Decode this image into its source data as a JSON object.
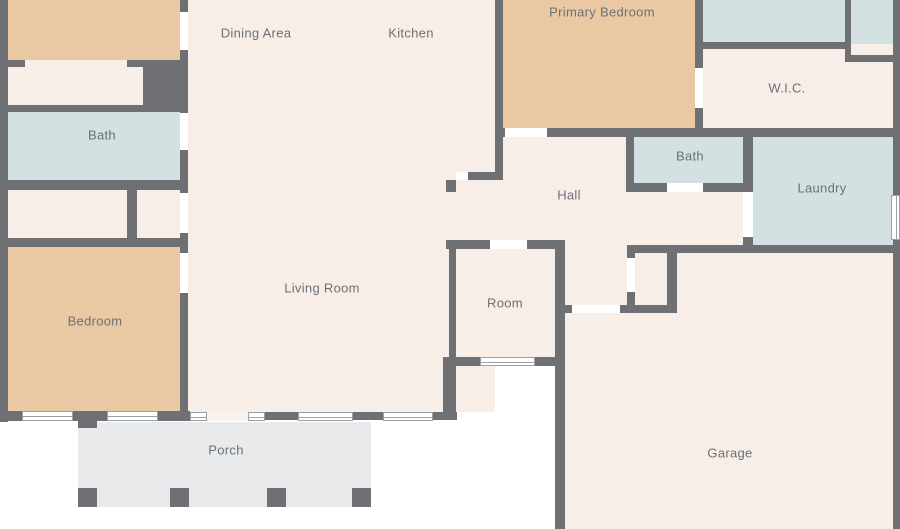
{
  "title": "floor-plan",
  "colors": {
    "wall": "#6e7073",
    "cream": "#f7eee8",
    "tan": "#ebc8a4",
    "blue": "#d3e1e3",
    "porch": "#e9eaec",
    "window": "#ffffff",
    "label_text": "#6b7178",
    "background": "#ffffff"
  },
  "labels": [
    {
      "name": "label-dining-area",
      "text": "Dining Area",
      "x": 256,
      "y": 33
    },
    {
      "name": "label-kitchen",
      "text": "Kitchen",
      "x": 411,
      "y": 33
    },
    {
      "name": "label-primary-bedroom",
      "text": "Primary Bedroom",
      "x": 602,
      "y": 12
    },
    {
      "name": "label-wic",
      "text": "W.I.C.",
      "x": 787,
      "y": 88
    },
    {
      "name": "label-bath-hall",
      "text": "Bath",
      "x": 690,
      "y": 156
    },
    {
      "name": "label-laundry",
      "text": "Laundry",
      "x": 822,
      "y": 188
    },
    {
      "name": "label-hall",
      "text": "Hall",
      "x": 569,
      "y": 195
    },
    {
      "name": "label-bath-left",
      "text": "Bath",
      "x": 102,
      "y": 135
    },
    {
      "name": "label-bedroom",
      "text": "Bedroom",
      "x": 95,
      "y": 321
    },
    {
      "name": "label-living-room",
      "text": "Living Room",
      "x": 322,
      "y": 288
    },
    {
      "name": "label-room",
      "text": "Room",
      "x": 505,
      "y": 303
    },
    {
      "name": "label-garage",
      "text": "Garage",
      "x": 730,
      "y": 453
    },
    {
      "name": "label-porch",
      "text": "Porch",
      "x": 226,
      "y": 450
    }
  ],
  "rooms": [
    {
      "name": "room-bedroom-top-fill",
      "color": "tan",
      "rect": [
        8,
        0,
        172,
        60
      ]
    },
    {
      "name": "room-closet-top-fill",
      "color": "cream",
      "rect": [
        8,
        60,
        135,
        45
      ]
    },
    {
      "name": "room-bath-left-fill",
      "color": "blue",
      "rect": [
        8,
        112,
        172,
        68
      ]
    },
    {
      "name": "room-closet-row-fill",
      "color": "cream",
      "rect": [
        8,
        188,
        172,
        52
      ]
    },
    {
      "name": "room-bedroom-fill",
      "color": "tan",
      "rect": [
        8,
        247,
        172,
        165
      ]
    },
    {
      "name": "room-main-open-fill",
      "color": "cream",
      "rect": [
        188,
        0,
        307,
        412
      ]
    },
    {
      "name": "room-primary-bedroom-fill",
      "color": "tan",
      "rect": [
        503,
        0,
        192,
        130
      ]
    },
    {
      "name": "room-blue-top-1-fill",
      "color": "blue",
      "rect": [
        703,
        0,
        142,
        44
      ]
    },
    {
      "name": "room-blue-top-2-fill",
      "color": "blue",
      "rect": [
        851,
        0,
        42,
        57
      ]
    },
    {
      "name": "room-wic-fill",
      "color": "cream",
      "rect": [
        697,
        44,
        196,
        84
      ]
    },
    {
      "name": "room-hall-fill",
      "color": "cream",
      "rect": [
        443,
        130,
        300,
        118
      ]
    },
    {
      "name": "room-bath-hall-fill",
      "color": "blue",
      "rect": [
        634,
        137,
        109,
        47
      ]
    },
    {
      "name": "room-laundry-fill",
      "color": "blue",
      "rect": [
        750,
        137,
        143,
        108
      ]
    },
    {
      "name": "room-room-fill",
      "color": "cream",
      "rect": [
        456,
        245,
        99,
        112
      ]
    },
    {
      "name": "room-garage-fill",
      "color": "cream",
      "rect": [
        560,
        245,
        333,
        284
      ]
    },
    {
      "name": "room-closet-garage-fill",
      "color": "cream",
      "rect": [
        635,
        253,
        32,
        50
      ]
    },
    {
      "name": "room-porch-fill",
      "color": "porch",
      "rect": [
        78,
        422,
        293,
        85
      ]
    }
  ],
  "walls": [
    {
      "name": "wall-left-exterior",
      "rect": [
        0,
        0,
        8,
        422
      ]
    },
    {
      "name": "wall-dining-left-top",
      "rect": [
        180,
        0,
        8,
        12
      ]
    },
    {
      "name": "wall-dining-left-mid",
      "rect": [
        180,
        50,
        8,
        63
      ]
    },
    {
      "name": "wall-thick-block",
      "rect": [
        143,
        60,
        39,
        52
      ]
    },
    {
      "name": "wall-closet-top-a",
      "rect": [
        0,
        60,
        25,
        7
      ]
    },
    {
      "name": "wall-closet-top-b",
      "rect": [
        127,
        60,
        16,
        7
      ]
    },
    {
      "name": "wall-bath-left-top",
      "rect": [
        0,
        105,
        182,
        7
      ]
    },
    {
      "name": "wall-bath-left-right",
      "rect": [
        180,
        150,
        8,
        43
      ]
    },
    {
      "name": "wall-bath-left-bottom",
      "rect": [
        0,
        180,
        183,
        10
      ]
    },
    {
      "name": "wall-closet-divider",
      "rect": [
        127,
        188,
        10,
        52
      ]
    },
    {
      "name": "wall-living-left-a",
      "rect": [
        180,
        233,
        8,
        20
      ]
    },
    {
      "name": "wall-bedroom-top",
      "rect": [
        0,
        238,
        188,
        9
      ]
    },
    {
      "name": "wall-bedroom-right",
      "rect": [
        180,
        293,
        8,
        119
      ]
    },
    {
      "name": "wall-bedroom-bottom-a",
      "rect": [
        0,
        411,
        22,
        10
      ]
    },
    {
      "name": "wall-bedroom-bottom-b",
      "rect": [
        73,
        411,
        34,
        10
      ]
    },
    {
      "name": "wall-bedroom-bottom-c",
      "rect": [
        158,
        411,
        32,
        10
      ]
    },
    {
      "name": "wall-living-bottom-a",
      "rect": [
        265,
        412,
        33,
        8
      ]
    },
    {
      "name": "wall-living-bottom-b",
      "rect": [
        353,
        412,
        30,
        8
      ]
    },
    {
      "name": "wall-living-bottom-c",
      "rect": [
        433,
        412,
        24,
        8
      ]
    },
    {
      "name": "wall-living-right-lower",
      "rect": [
        443,
        357,
        13,
        63
      ]
    },
    {
      "name": "wall-room-left",
      "rect": [
        449,
        240,
        7,
        126
      ]
    },
    {
      "name": "wall-room-top-a",
      "rect": [
        446,
        240,
        44,
        9
      ]
    },
    {
      "name": "wall-room-top-b",
      "rect": [
        527,
        240,
        38,
        9
      ]
    },
    {
      "name": "wall-room-bottom",
      "rect": [
        449,
        357,
        116,
        9
      ]
    },
    {
      "name": "wall-room-garage-right",
      "rect": [
        555,
        240,
        10,
        289
      ]
    },
    {
      "name": "wall-garage-door-stub",
      "rect": [
        562,
        305,
        10,
        8
      ]
    },
    {
      "name": "wall-garage-top-left",
      "rect": [
        620,
        305,
        57,
        8
      ]
    },
    {
      "name": "wall-closet-garage-left-a",
      "rect": [
        627,
        250,
        8,
        8
      ]
    },
    {
      "name": "wall-closet-garage-left-b",
      "rect": [
        627,
        292,
        8,
        13
      ]
    },
    {
      "name": "wall-closet-garage-right",
      "rect": [
        667,
        250,
        10,
        58
      ]
    },
    {
      "name": "wall-laundry-garage-bottom",
      "rect": [
        627,
        245,
        273,
        8
      ]
    },
    {
      "name": "wall-kitchen-right",
      "rect": [
        495,
        0,
        8,
        180
      ]
    },
    {
      "name": "wall-primary-bottom-stub",
      "rect": [
        495,
        128,
        10,
        9
      ]
    },
    {
      "name": "wall-primary-bottom",
      "rect": [
        547,
        128,
        353,
        9
      ]
    },
    {
      "name": "wall-hall-nook",
      "rect": [
        468,
        172,
        35,
        8
      ]
    },
    {
      "name": "wall-hall-nook-stub",
      "rect": [
        446,
        180,
        10,
        12
      ]
    },
    {
      "name": "wall-bath-hall-left",
      "rect": [
        626,
        128,
        8,
        62
      ]
    },
    {
      "name": "wall-bath-hall-bottom-a",
      "rect": [
        626,
        183,
        41,
        9
      ]
    },
    {
      "name": "wall-bath-hall-bottom-b",
      "rect": [
        703,
        183,
        47,
        9
      ]
    },
    {
      "name": "wall-laundry-left-a",
      "rect": [
        743,
        128,
        10,
        64
      ]
    },
    {
      "name": "wall-laundry-left-b",
      "rect": [
        743,
        237,
        10,
        16
      ]
    },
    {
      "name": "wall-primary-right-a",
      "rect": [
        695,
        0,
        8,
        68
      ]
    },
    {
      "name": "wall-primary-right-b",
      "rect": [
        695,
        108,
        8,
        29
      ]
    },
    {
      "name": "wall-blue1-bottom",
      "rect": [
        697,
        42,
        154,
        7
      ]
    },
    {
      "name": "wall-blue2-left",
      "rect": [
        845,
        0,
        6,
        62
      ]
    },
    {
      "name": "wall-blue2-bottom",
      "rect": [
        845,
        55,
        55,
        7
      ]
    },
    {
      "name": "wall-right-exterior",
      "rect": [
        893,
        0,
        7,
        529
      ]
    }
  ],
  "doors": [
    {
      "name": "door-bedroomtop-dining",
      "rect": [
        180,
        12,
        8,
        38
      ],
      "style": "white"
    },
    {
      "name": "door-bath-left",
      "rect": [
        180,
        113,
        8,
        37
      ],
      "style": "white"
    },
    {
      "name": "door-closet-row",
      "rect": [
        180,
        193,
        8,
        40
      ],
      "style": "white"
    },
    {
      "name": "door-bedroom",
      "rect": [
        180,
        253,
        8,
        40
      ],
      "style": "white"
    },
    {
      "name": "door-primary-bedroom",
      "rect": [
        505,
        128,
        42,
        9
      ],
      "style": "white"
    },
    {
      "name": "door-room",
      "rect": [
        490,
        240,
        37,
        9
      ],
      "style": "white"
    },
    {
      "name": "door-garage",
      "rect": [
        572,
        305,
        48,
        8
      ],
      "style": "white"
    },
    {
      "name": "door-closet-garage",
      "rect": [
        627,
        258,
        8,
        34
      ],
      "style": "white"
    },
    {
      "name": "door-bath-hall",
      "rect": [
        667,
        183,
        36,
        9
      ],
      "style": "white"
    },
    {
      "name": "door-laundry",
      "rect": [
        743,
        192,
        10,
        45
      ],
      "style": "white"
    },
    {
      "name": "door-wic",
      "rect": [
        695,
        68,
        8,
        40
      ],
      "style": "white"
    },
    {
      "name": "door-hall-nook",
      "rect": [
        456,
        172,
        12,
        8
      ],
      "style": "white"
    },
    {
      "name": "door-front-entry",
      "rect": [
        207,
        412,
        41,
        9
      ],
      "style": "cream"
    }
  ],
  "windows": [
    {
      "name": "window-bedroom-1",
      "rect": [
        22,
        411,
        51,
        10
      ],
      "dir": "h"
    },
    {
      "name": "window-bedroom-2",
      "rect": [
        107,
        411,
        51,
        10
      ],
      "dir": "h"
    },
    {
      "name": "window-entry-sidelight-1",
      "rect": [
        190,
        412,
        17,
        9
      ],
      "dir": "h"
    },
    {
      "name": "window-entry-sidelight-2",
      "rect": [
        248,
        412,
        17,
        9
      ],
      "dir": "h"
    },
    {
      "name": "window-living-1",
      "rect": [
        298,
        412,
        55,
        9
      ],
      "dir": "h"
    },
    {
      "name": "window-living-2",
      "rect": [
        383,
        412,
        50,
        9
      ],
      "dir": "h"
    },
    {
      "name": "window-room",
      "rect": [
        480,
        357,
        55,
        9
      ],
      "dir": "h"
    },
    {
      "name": "window-laundry",
      "rect": [
        891,
        195,
        9,
        45
      ],
      "dir": "v"
    }
  ],
  "posts": [
    {
      "name": "porch-post-1",
      "rect": [
        78,
        488,
        19,
        19
      ]
    },
    {
      "name": "porch-post-2",
      "rect": [
        170,
        488,
        19,
        19
      ]
    },
    {
      "name": "porch-post-3",
      "rect": [
        267,
        488,
        19,
        19
      ]
    },
    {
      "name": "porch-post-4",
      "rect": [
        352,
        488,
        19,
        19
      ]
    },
    {
      "name": "porch-post-top",
      "rect": [
        78,
        418,
        19,
        10
      ]
    }
  ]
}
